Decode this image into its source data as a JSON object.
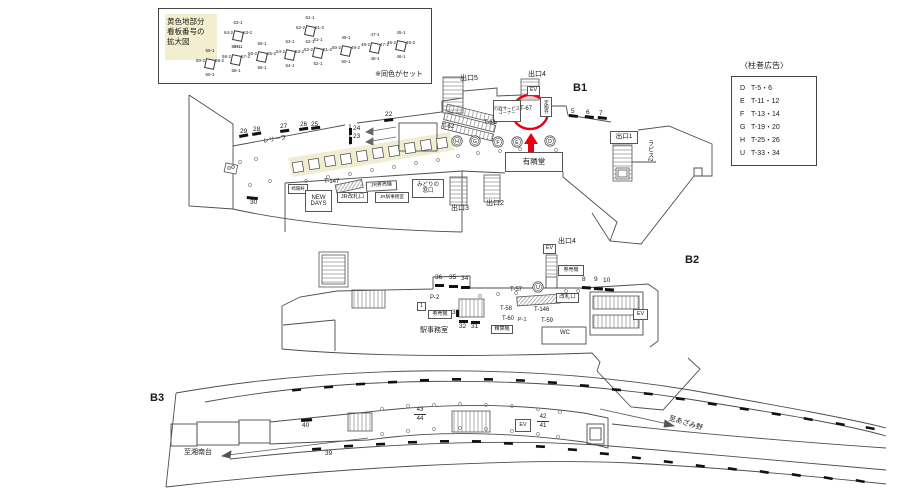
{
  "floors": {
    "b1": "B1",
    "b2": "B2",
    "b3": "B3"
  },
  "legend": {
    "title": "黄色地部分\n看板番号の\n拡大図",
    "note": "※同色がセット",
    "icons": [
      {
        "top": "63-1",
        "right": "63-2",
        "bottom": "64-1",
        "left": "64-2"
      },
      {
        "top": "61-1",
        "right": "61-2",
        "bottom": "62-1",
        "left": "62-2"
      },
      {
        "top": "59-1",
        "right": "59-2",
        "bottom": "60-1",
        "left": "60-2"
      },
      {
        "top": "57-1",
        "right": "57-2",
        "bottom": "58-1",
        "left": "58-2"
      },
      {
        "top": "55-1",
        "right": "55-2",
        "bottom": "56-1",
        "left": "56-2"
      },
      {
        "top": "53-1",
        "right": "53-2",
        "bottom": "54-1",
        "left": "54-2"
      },
      {
        "top": "51-1",
        "right": "51-2",
        "bottom": "52-1",
        "left": "52-2"
      },
      {
        "top": "49-1",
        "right": "49-2",
        "bottom": "50-1",
        "left": "50-2"
      },
      {
        "top": "47-1",
        "right": "47-2",
        "bottom": "48-1",
        "left": "48-2"
      },
      {
        "top": "45-1",
        "right": "45-2",
        "bottom": "46-1",
        "left": "46-2"
      }
    ]
  },
  "pillar_ads": {
    "title": "〈柱巻広告〉",
    "rows": [
      {
        "k": "D",
        "v": "T-5・6"
      },
      {
        "k": "E",
        "v": "T-11・12"
      },
      {
        "k": "F",
        "v": "T-13・14"
      },
      {
        "k": "G",
        "v": "T-19・20"
      },
      {
        "k": "H",
        "v": "T-25・26"
      },
      {
        "k": "U",
        "v": "T-33・34"
      }
    ]
  },
  "t": {
    "exit1": "出口1",
    "exit2": "出口2",
    "exit3": "出口3",
    "exit4": "出口4",
    "exit5": "出口5",
    "exit4_b2": "出口4",
    "ev": "EV",
    "t57": "T-57",
    "t58": "T-58",
    "t59": "T-59",
    "t60": "T-60",
    "t61": "T-61",
    "t62": "T-62",
    "t67": "T-67",
    "t146": "T-146",
    "t147": "T-147",
    "p1": "P-1",
    "p2": "P-2",
    "one": "1",
    "gyosei": "行政サービス\nコーナー",
    "teikiken": "定期券",
    "yurindo": "有隣堂",
    "kiyoken": "崎陽軒",
    "newdays": "NEW\nDAYS",
    "jr_gate": "JR改札口",
    "jr_tvm": "JR券売機",
    "jr_office": "JR駅事務室",
    "midori": "みどりの\n窓口",
    "gate": "改札口",
    "tvm": "券売機",
    "fare": "精算機",
    "office": "駅事務室",
    "wc": "WC",
    "lapis": "ラピス2",
    "relief": "レリーフ",
    "to_shonandai": "至湘南台",
    "to_azamino": "至あざみ野",
    "cD": "D",
    "cE": "E",
    "cF": "F",
    "cG": "G",
    "cH": "H",
    "cU": "U",
    "n5": "5",
    "n6": "6",
    "n7": "7",
    "n8": "8",
    "n9": "9",
    "n10": "10",
    "n22": "22",
    "n23": "23",
    "n24": "24",
    "n25": "25",
    "n26": "26",
    "n27": "27",
    "n28": "28",
    "n29": "29",
    "n30": "30",
    "n31": "31",
    "n32": "32",
    "n33": "33",
    "n34": "34",
    "n35": "35",
    "n36": "36",
    "n39": "39",
    "n40": "40",
    "n41": "41",
    "n42": "42",
    "n43": "43",
    "n44": "44"
  }
}
